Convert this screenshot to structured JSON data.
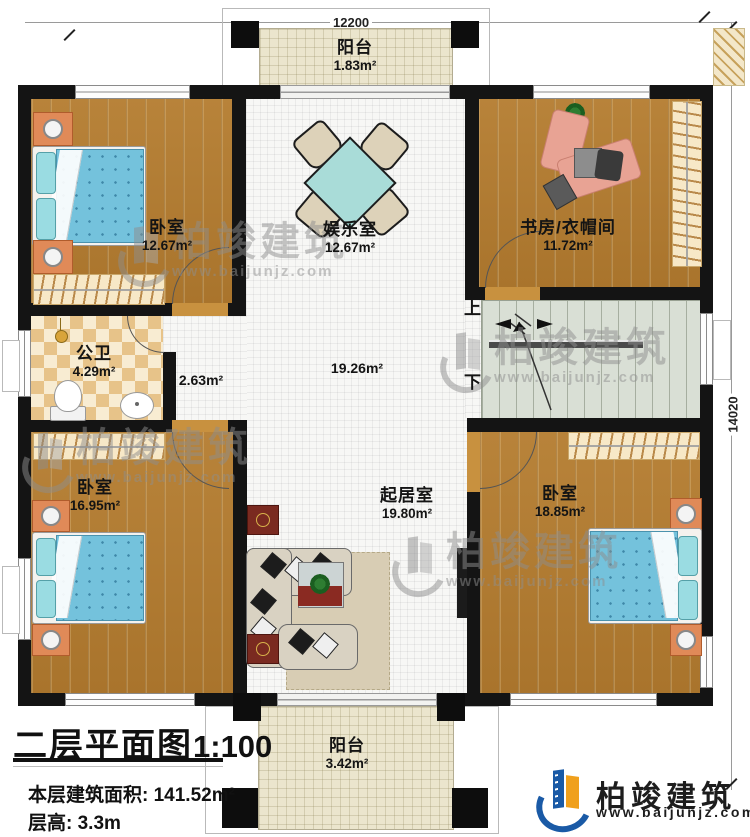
{
  "dimensions": {
    "width_mm": "12200",
    "height_mm": "14020"
  },
  "plan": {
    "balcony_top": {
      "name": "阳台",
      "area": "1.83m²"
    },
    "bedroom_top_left": {
      "name": "卧室",
      "area": "12.67m²"
    },
    "entertainment_room": {
      "name": "娱乐室",
      "area": "12.67m²"
    },
    "study_cloakroom": {
      "name": "书房/衣帽间",
      "area": "11.72m²"
    },
    "bathroom": {
      "name": "公卫",
      "area": "4.29m²"
    },
    "corridor": {
      "area": "2.63m²"
    },
    "hall": {
      "area": "19.26m²"
    },
    "stairs": {
      "up_label": "上",
      "down_label": "下"
    },
    "bedroom_bottom_left": {
      "name": "卧室",
      "area": "16.95m²"
    },
    "living_room": {
      "name": "起居室",
      "area": "19.80m²"
    },
    "bedroom_bottom_right": {
      "name": "卧室",
      "area": "18.85m²"
    },
    "balcony_bottom": {
      "name": "阳台",
      "area": "3.42m²"
    }
  },
  "title_block": {
    "title": "二层平面图",
    "scale": "1:100",
    "floor_area_label": "本层建筑面积:",
    "floor_area_value": "141.52m²",
    "floor_height_label": "层高:",
    "floor_height_value": "3.3m"
  },
  "brand": {
    "name": "柏竣建筑",
    "website": "www.baijunjz.com"
  },
  "watermark": {
    "name": "柏竣建筑",
    "website": "www.baijunjz.com"
  },
  "colors": {
    "wall": "#141414",
    "accent_blue": "#1a5aa6",
    "accent_orange": "#f0a01c",
    "wood_floor": "#b17c33",
    "balcony_floor": "#ebe5cd",
    "stairs_floor": "#d9dfd5"
  }
}
